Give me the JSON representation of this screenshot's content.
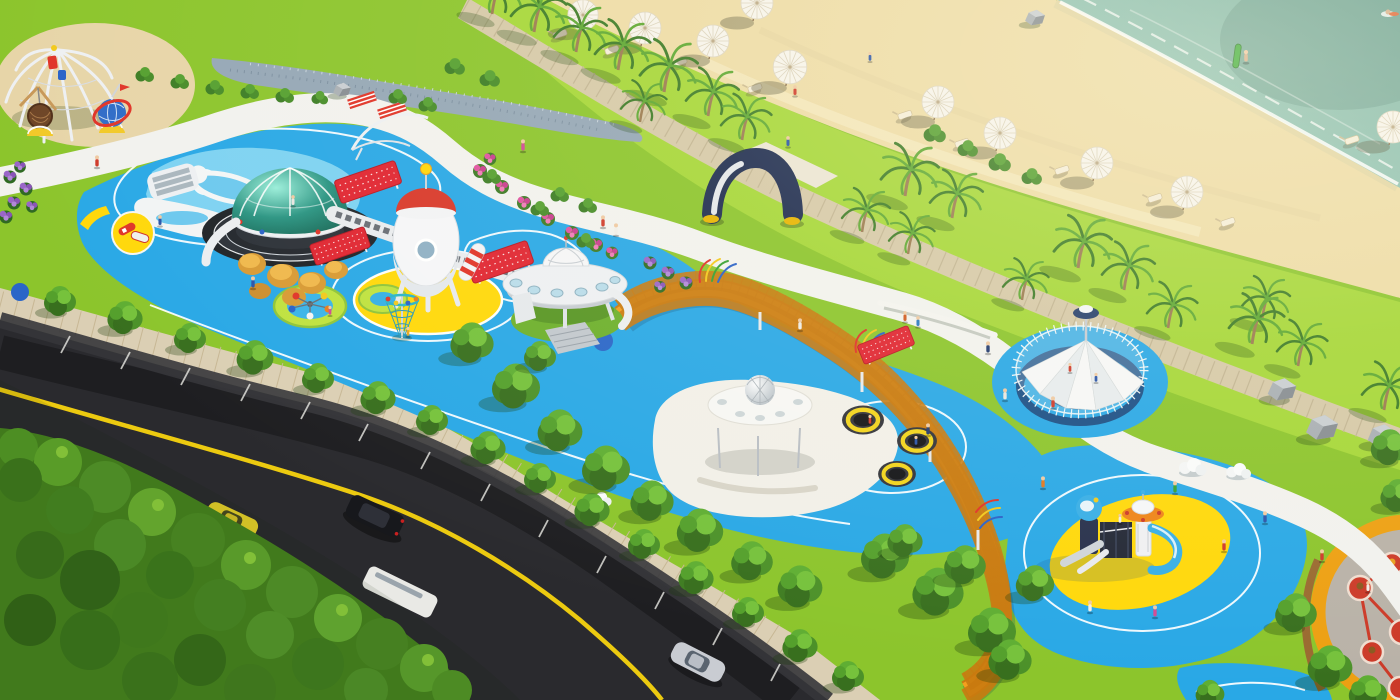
{
  "meta": {
    "title": "Aerial 3D rendering of a space-themed seaside children's playground park",
    "view": "isometric aerial render",
    "visible_text": "none"
  },
  "colors": {
    "ocean": "#86bcae",
    "ocean_shallow": "#bcd9c4",
    "sand": "#eedca6",
    "sand_light": "#f6ecc6",
    "grass": "#8cc52c",
    "grass_light": "#a6d738",
    "grass_dark": "#47841f",
    "track_red": "#c53a2c",
    "play_blue": "#29a8e6",
    "play_blue_light": "#7dd2f2",
    "pad_yellow": "#ffd80a",
    "pad_white": "#f2f0e8",
    "path_orange": "#f49f1e",
    "path_orange_dark": "#c97a10",
    "road": "#2a2a2e",
    "road_yellow": "#ecca10",
    "paver": "#dbcfb4",
    "boardwalk": "#d6c9a8",
    "navy": "#1e2c50",
    "dome_teal": "#2a9482",
    "ufo_white": "#eef0f3",
    "rocket_red": "#d9382a",
    "panel_red": "#e02531",
    "umbrella_white": "#f7f4ec",
    "car_yellow": "#e8d22a",
    "car_black": "#17181c",
    "car_silver": "#c9ccd2"
  },
  "scene": {
    "areas": [
      "ocean with swimmers",
      "sandy beach with parasols and loungers",
      "palm-lined boardwalk",
      "space-themed playground on blue rubber surfacing",
      "red running track",
      "orange elevated walkway",
      "tree-lined avenue with road and cars",
      "dense tree canopy"
    ],
    "objects": [
      "rope climbing spider structure",
      "nest basket swing",
      "globe climber with red ring",
      "glass observation dome on striped ring base",
      "amber boulder seats",
      "white space rocket on yellow launch pad",
      "red perforated climbing panels",
      "crawl tube bridges",
      "UFO pavilion on grass mound",
      "rope funnel climber",
      "seat spinner carousel",
      "round shade pavilion with geodesic ball",
      "three sunken trampolines",
      "sail-canopy water play enclosure",
      "penguin arch sculpture",
      "astronaut and rocket play towers with slides",
      "spring rider constellation pad",
      "beach umbrellas",
      "beach loungers",
      "surfer with green surfboard",
      "boulders"
    ],
    "vehicle_labels": [
      "yellow sports car",
      "black SUV",
      "white shuttle",
      "silver sedan"
    ],
    "counts": {
      "beach_umbrellas": 10,
      "trampolines": 3,
      "vehicles": 4
    }
  }
}
